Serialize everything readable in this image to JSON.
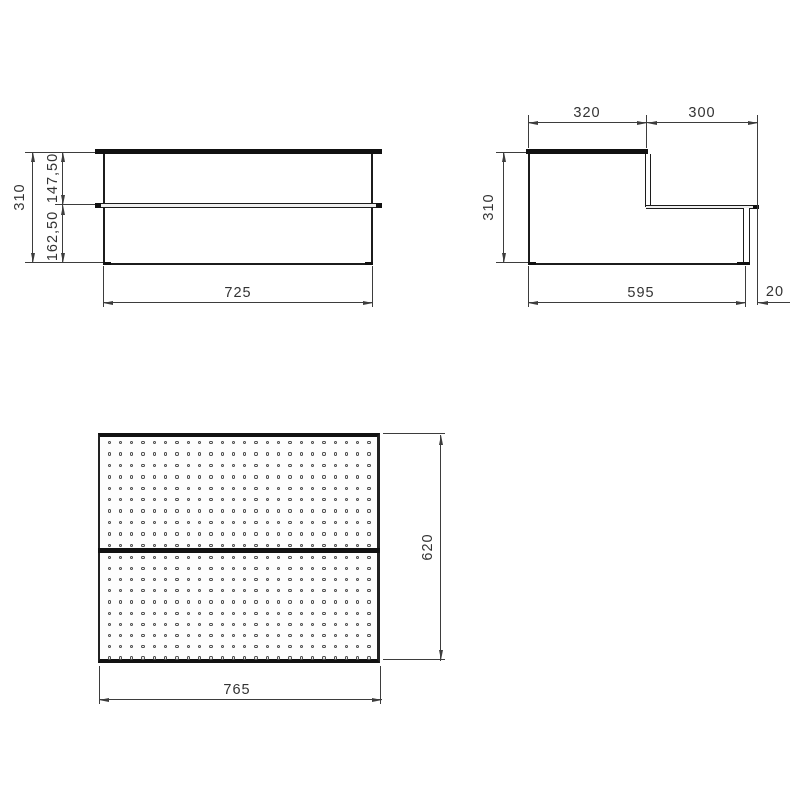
{
  "front_view": {
    "dims": {
      "total_height": "310",
      "upper_section_height": "147,50",
      "lower_section_height": "162,50",
      "overall_width": "725"
    }
  },
  "side_view": {
    "dims": {
      "upper_tread_depth": "320",
      "lower_tread_depth": "300",
      "total_height": "310",
      "base_depth": "595",
      "lip_overhang": "20"
    }
  },
  "plan_view": {
    "dims": {
      "overall_depth": "620",
      "overall_width": "765"
    },
    "perforation_grid": {
      "panels": 2,
      "rows_per_panel": 10,
      "columns": 24
    }
  },
  "colors": {
    "background": "#ffffff",
    "body_line": "#1c1c1c",
    "thick_fill": "#111111",
    "dimension_line": "#3d3d3d",
    "text": "#333333"
  }
}
